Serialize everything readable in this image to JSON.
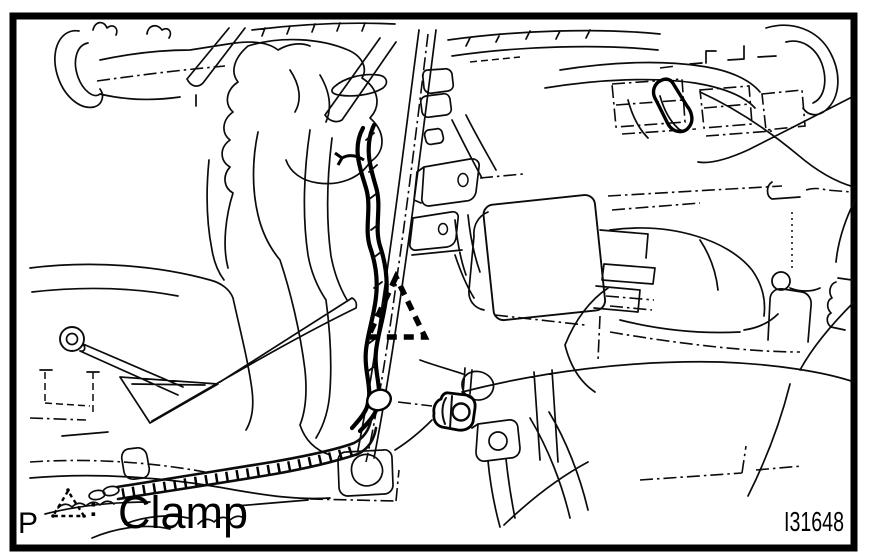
{
  "figure": {
    "number": "I31648"
  },
  "legend": {
    "prefix": "P",
    "symbol_icon": "dashed-triangle-clamp-icon",
    "separator": ":",
    "label": "Clamp"
  },
  "colors": {
    "line": "#000000",
    "background": "#ffffff"
  }
}
